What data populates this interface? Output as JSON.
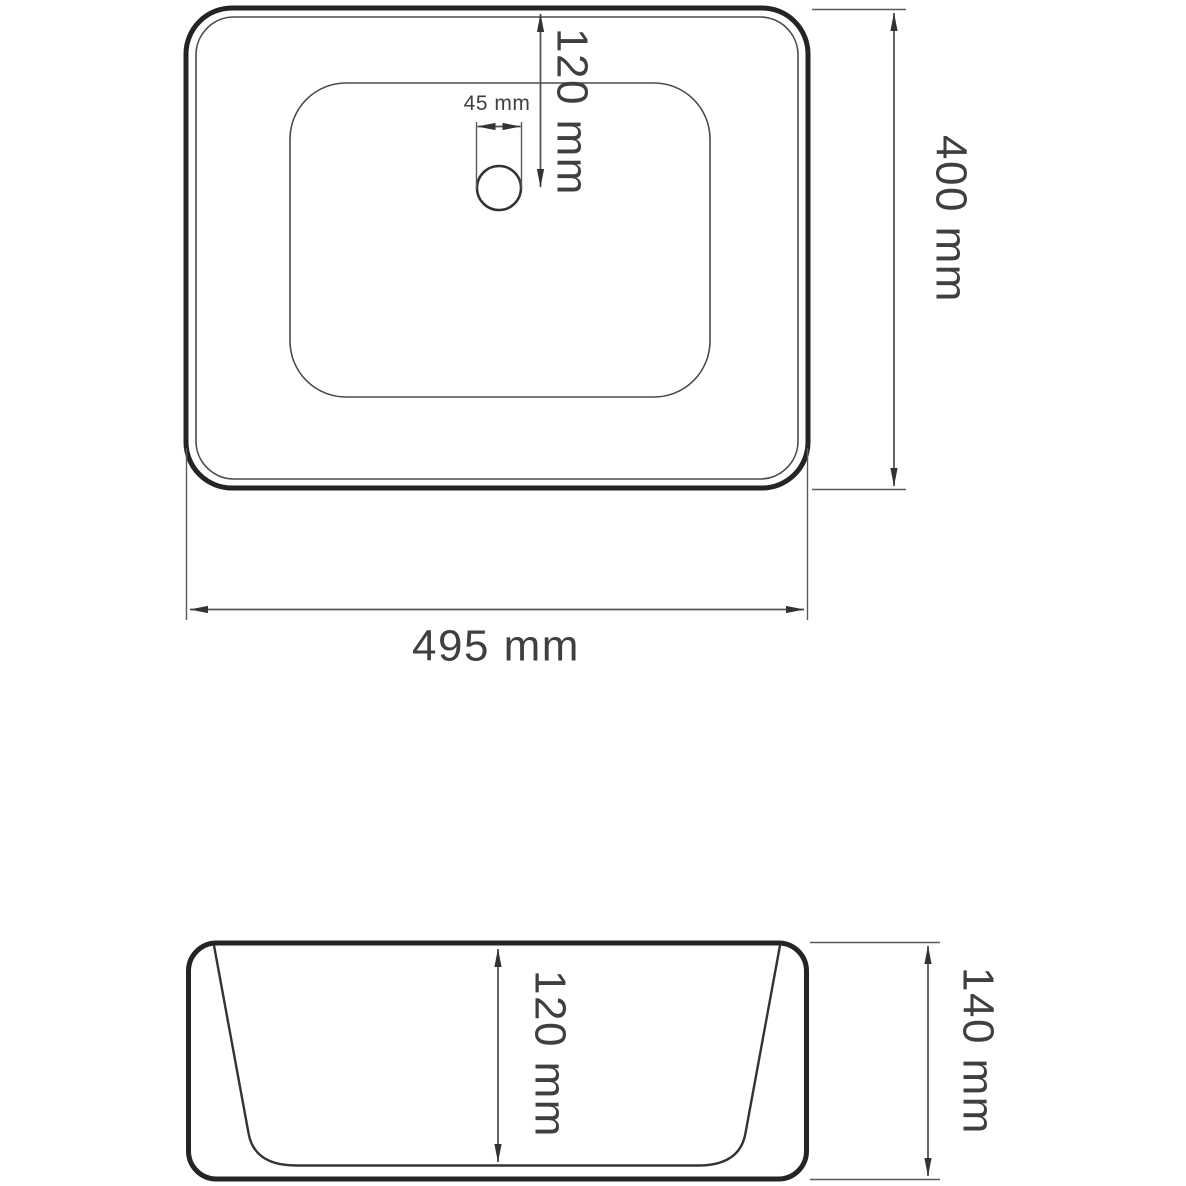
{
  "drawing": {
    "type": "technical-drawing",
    "subject": "countertop-sink",
    "colors": {
      "background": "#ffffff",
      "outline_thick": "#242424",
      "outline_thin": "#4a4a4a",
      "dimension_line": "#555555",
      "text": "#3f3f3f"
    },
    "top_view": {
      "width_label": "495 mm",
      "height_label": "400 mm",
      "drain_offset_label": "120 mm",
      "drain_diameter_label": "45 mm"
    },
    "side_view": {
      "basin_depth_label": "120 mm",
      "overall_height_label": "140 mm"
    }
  }
}
